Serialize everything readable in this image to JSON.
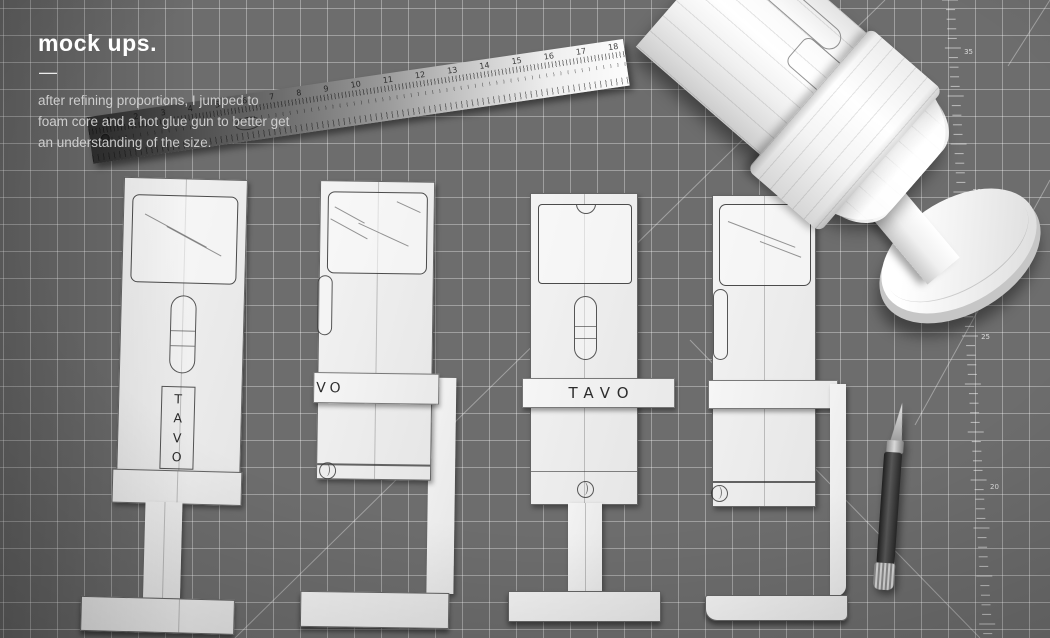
{
  "overlay": {
    "title": "mock ups.",
    "divider": "—",
    "description_lines": [
      "after refining proportions, I jumped to",
      "foam core and a hot glue gun to better get",
      "an understanding of the size."
    ]
  },
  "ruler": {
    "inch_numbers": [
      "1",
      "2",
      "3",
      "4",
      "5",
      "6",
      "7",
      "8",
      "9",
      "10",
      "11",
      "12",
      "13",
      "14",
      "15",
      "16",
      "17",
      "18"
    ]
  },
  "mat": {
    "scale_numbers": [
      "35",
      "30",
      "25",
      "20"
    ]
  },
  "mockups": {
    "vertical_letters": [
      "T",
      "A",
      "V",
      "O"
    ],
    "side_band_text": "VO",
    "front_band_text": "TAVO"
  },
  "palette": {
    "mat": "#6d6d6d",
    "grid_line": "#ffffff",
    "paper": "#f1f1f1",
    "pencil": "#3f3f3f",
    "knife_handle": "#3a3a3a"
  }
}
